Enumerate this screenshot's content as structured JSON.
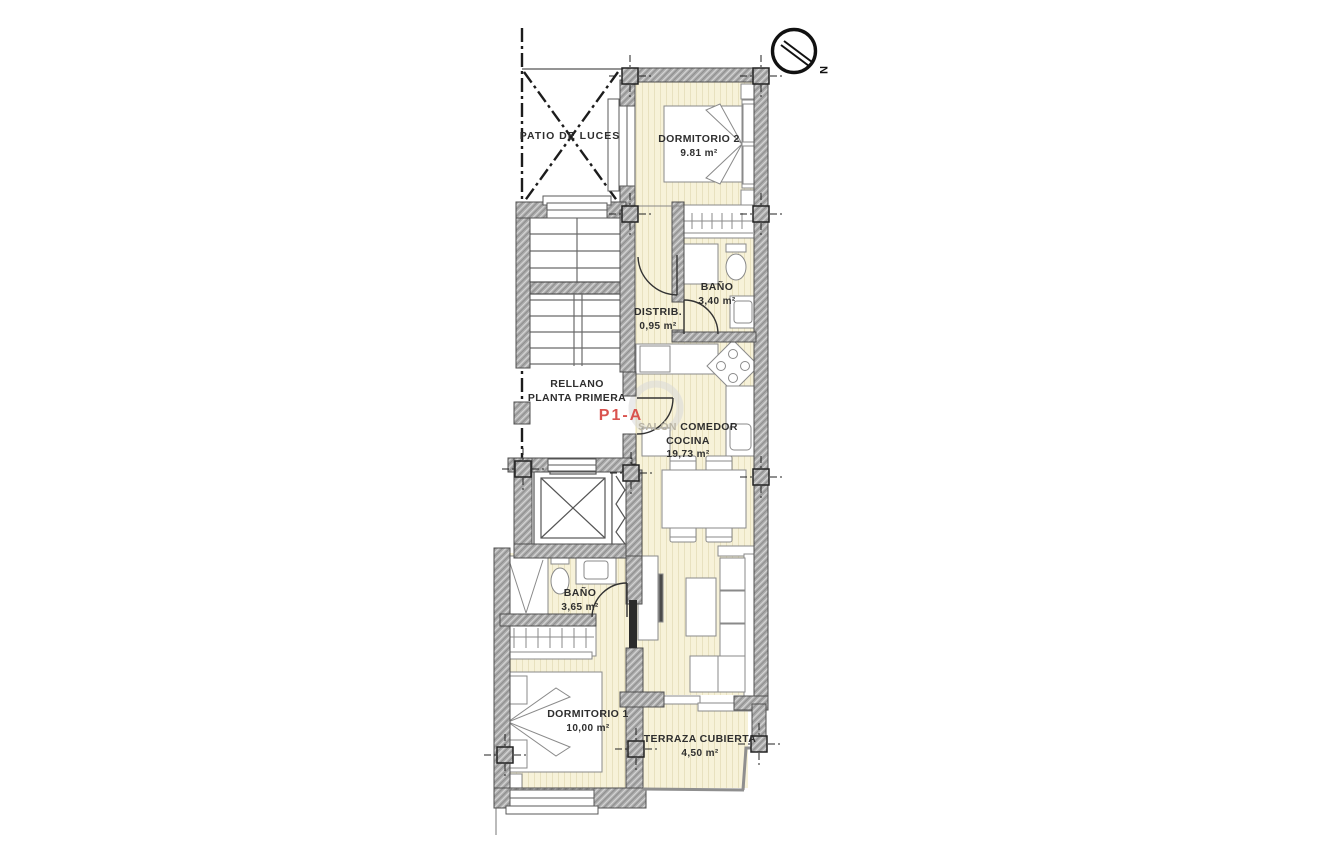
{
  "plan": {
    "unit_label": "P1-A",
    "compass_label": "N",
    "rooms": {
      "patio": {
        "label": "PATIO DE LUCES"
      },
      "dormitorio2": {
        "label": "DORMITORIO 2",
        "area": "9.81 m²"
      },
      "bano_superior": {
        "label": "BAÑO",
        "area": "3,40 m²"
      },
      "distribuidor": {
        "label": "DISTRIB.",
        "area": "0,95 m²"
      },
      "rellano": {
        "line1": "RELLANO",
        "line2": "PLANTA PRIMERA"
      },
      "salon": {
        "word1": "SALÓN",
        "word2": "COMEDOR",
        "line2": "COCINA",
        "area": "19,73 m²"
      },
      "bano_inferior": {
        "label": "BAÑO",
        "area": "3,65 m²"
      },
      "dormitorio1": {
        "label": "DORMITORIO 1",
        "area": "10,00 m²"
      },
      "terraza": {
        "label": "TERRAZA CUBIERTA",
        "area": "4,50 m²"
      }
    },
    "colors": {
      "floor": "#f7f2d9",
      "floor_stripe": "#e8e1bf",
      "wall": "#ababab",
      "line": "#4f4f4f",
      "accent": "#d9534f"
    }
  }
}
